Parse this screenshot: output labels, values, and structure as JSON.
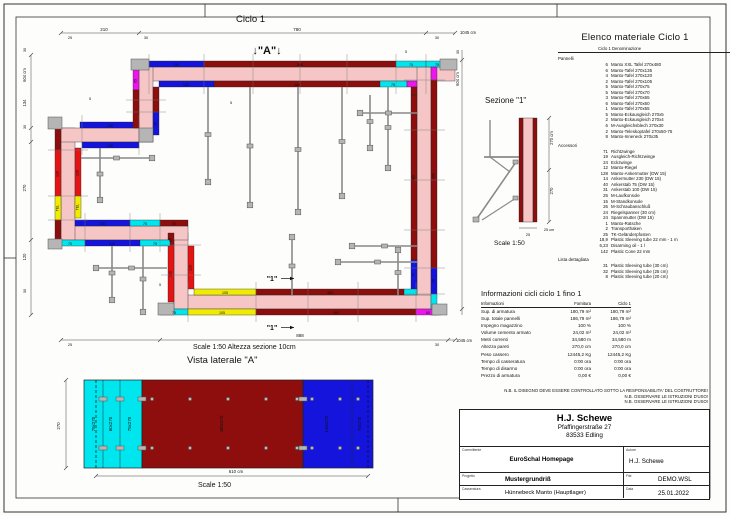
{
  "sheet": {
    "ciclo_label": "Ciclo 1",
    "a_marker": "↓\"A\"↓",
    "cut_marker": "\"1\"",
    "plan_scale_note": "Scale 1:50   Altezza sezione 10cm",
    "vista_title": "Vista laterale \"A\"",
    "vista_scale": "Scale 1:50",
    "sezione_title": "Sezione \"1\"",
    "sezione_scale": "Scale 1:50"
  },
  "colors": {
    "wall": "#f6c5c5",
    "panel_xxl_darkred": "#8e0e0e",
    "panel_red": "#e51414",
    "panel_blue": "#1414dc",
    "panel_cyan": "#00e6ee",
    "panel_magenta": "#ee14ee",
    "panel_yellow": "#f0ec00",
    "hardware_gray": "#b5b5b5"
  },
  "plan": {
    "dim_labels": [
      {
        "t": "210",
        "x": 104,
        "y": 31,
        "r": 0,
        "s": 4.5
      },
      {
        "t": "780",
        "x": 297,
        "y": 31,
        "r": 0,
        "s": 4.5
      },
      {
        "t": "1045 cm",
        "x": 468,
        "y": 34,
        "r": 0,
        "s": 4.2
      },
      {
        "t": "25",
        "x": 70,
        "y": 39,
        "r": 0,
        "s": 3.8
      },
      {
        "t": "30",
        "x": 146,
        "y": 39,
        "r": 0,
        "s": 3.8
      },
      {
        "t": "30",
        "x": 437,
        "y": 39,
        "r": 0,
        "s": 3.8
      },
      {
        "t": "30",
        "x": 26,
        "y": 50,
        "r": -90,
        "s": 3.8
      },
      {
        "t": "604 cm",
        "x": 26,
        "y": 75,
        "r": -90,
        "s": 4.2
      },
      {
        "t": "134",
        "x": 26,
        "y": 103,
        "r": -90,
        "s": 4.2
      },
      {
        "t": "30",
        "x": 26,
        "y": 127,
        "r": -90,
        "s": 3.8
      },
      {
        "t": "270",
        "x": 26,
        "y": 188,
        "r": -90,
        "s": 4.2
      },
      {
        "t": "120",
        "x": 26,
        "y": 257,
        "r": -90,
        "s": 4.2
      },
      {
        "t": "30",
        "x": 26,
        "y": 291,
        "r": -90,
        "s": 3.8
      },
      {
        "t": "25",
        "x": 70,
        "y": 346,
        "r": 0,
        "s": 3.8
      },
      {
        "t": "888",
        "x": 300,
        "y": 337,
        "r": 0,
        "s": 4.5
      },
      {
        "t": "30",
        "x": 437,
        "y": 346,
        "r": 0,
        "s": 3.8
      },
      {
        "t": "1045 cm",
        "x": 464,
        "y": 342,
        "r": 0,
        "s": 4.2
      },
      {
        "t": "30",
        "x": 459,
        "y": 52,
        "r": -90,
        "s": 3.8
      },
      {
        "t": "604 cm",
        "x": 459,
        "y": 79,
        "r": -90,
        "s": 4.2
      }
    ],
    "panel_labels": [
      {
        "t": "135",
        "x": 176,
        "y": 65.8,
        "r": 0
      },
      {
        "t": "480",
        "x": 300,
        "y": 65.8,
        "r": 0
      },
      {
        "t": "75",
        "x": 411,
        "y": 65.8,
        "r": 0
      },
      {
        "t": "75",
        "x": 437,
        "y": 65.8,
        "r": 0
      },
      {
        "t": "135",
        "x": 186,
        "y": 85.8,
        "r": 0
      },
      {
        "t": "480",
        "x": 297,
        "y": 85.8,
        "r": 0
      },
      {
        "t": "75",
        "x": 393,
        "y": 85.8,
        "r": 0
      },
      {
        "t": "480",
        "x": 434.5,
        "y": 176,
        "r": -90
      },
      {
        "t": "70",
        "x": 434.5,
        "y": 281,
        "r": -90
      },
      {
        "t": "480",
        "x": 414.5,
        "y": 178,
        "r": -90
      },
      {
        "t": "70",
        "x": 414.5,
        "y": 275,
        "r": -90
      },
      {
        "t": "105",
        "x": 225,
        "y": 293.8,
        "r": 0
      },
      {
        "t": "480",
        "x": 330,
        "y": 293.8,
        "r": 0
      },
      {
        "t": "75",
        "x": 174,
        "y": 313.8,
        "r": 0
      },
      {
        "t": "105",
        "x": 222,
        "y": 313.8,
        "r": 0
      },
      {
        "t": "480",
        "x": 336,
        "y": 313.8,
        "r": 0
      },
      {
        "t": "65",
        "x": 428,
        "y": 313.8,
        "r": 0
      },
      {
        "t": "30",
        "x": 171.5,
        "y": 240,
        "r": -90
      },
      {
        "t": "120",
        "x": 171.5,
        "y": 274,
        "r": -90
      },
      {
        "t": "120",
        "x": 191.5,
        "y": 268,
        "r": -90
      },
      {
        "t": "135",
        "x": 102,
        "y": 224.8,
        "r": 0
      },
      {
        "t": "75",
        "x": 145,
        "y": 224.8,
        "r": 0
      },
      {
        "t": "30",
        "x": 174,
        "y": 224.8,
        "r": 0
      },
      {
        "t": "75",
        "x": 70,
        "y": 244.8,
        "r": 0
      },
      {
        "t": "135",
        "x": 112,
        "y": 244.8,
        "r": 0
      },
      {
        "t": "75",
        "x": 155,
        "y": 244.8,
        "r": 0
      },
      {
        "t": "120",
        "x": 58.5,
        "y": 174,
        "r": -90
      },
      {
        "t": "TEL",
        "x": 58.5,
        "y": 208,
        "r": -90
      },
      {
        "t": "120",
        "x": 78.5,
        "y": 173,
        "r": -90
      },
      {
        "t": "TEL",
        "x": 78.5,
        "y": 207,
        "r": -90
      },
      {
        "t": "135",
        "x": 110,
        "y": 126.8,
        "r": 0
      },
      {
        "t": "135",
        "x": 110,
        "y": 146.8,
        "r": 0
      },
      {
        "t": "65",
        "x": 136.5,
        "y": 81,
        "r": -90
      },
      {
        "t": "35",
        "x": 156.5,
        "y": 124,
        "r": -90
      }
    ],
    "annotations": [
      {
        "t": "5",
        "x": 231,
        "y": 104
      },
      {
        "t": "5",
        "x": 90,
        "y": 100
      },
      {
        "t": "5",
        "x": 406,
        "y": 53
      },
      {
        "t": "5",
        "x": 160,
        "y": 286
      }
    ]
  },
  "sezione": {
    "labels": [
      {
        "t": "270 cm",
        "x": 553,
        "y": 138,
        "r": -90,
        "s": 4.2
      },
      {
        "t": "270",
        "x": 553,
        "y": 191,
        "r": -90,
        "s": 4.2
      },
      {
        "t": "25 cm",
        "x": 549,
        "y": 231,
        "r": 0,
        "s": 3.8
      },
      {
        "t": "25",
        "x": 528,
        "y": 236,
        "r": 0,
        "s": 3.8
      }
    ]
  },
  "vista": {
    "labels": [
      {
        "t": "75x270",
        "x": 95,
        "y": 424,
        "r": -90,
        "s": 4.4
      },
      {
        "t": "60x270",
        "x": 112,
        "y": 424,
        "r": -90,
        "s": 4.4
      },
      {
        "t": "75x270",
        "x": 131,
        "y": 424,
        "r": -90,
        "s": 4.4
      },
      {
        "t": "480x270",
        "x": 223,
        "y": 424,
        "r": -90,
        "s": 4.4
      },
      {
        "t": "135x270",
        "x": 328,
        "y": 424,
        "r": -90,
        "s": 4.4
      },
      {
        "t": "70x270",
        "x": 361,
        "y": 424,
        "r": -90,
        "s": 4.4
      },
      {
        "t": "270",
        "x": 60,
        "y": 426,
        "r": -90,
        "s": 4.4
      },
      {
        "t": "610 cm",
        "x": 236,
        "y": 473,
        "r": 0,
        "s": 4.4
      }
    ]
  },
  "material_list": {
    "title": "Elenco materiale  Ciclo 1",
    "col_header": "Ciclo 1   Denominazione",
    "groups": [
      {
        "name": "Pannelli",
        "items": [
          {
            "qty": "6",
            "name": "Manto XXL Tafel 270x480"
          },
          {
            "qty": "6",
            "name": "Manto-Tafel 270x135"
          },
          {
            "qty": "4",
            "name": "Manto-Tafel 270x120"
          },
          {
            "qty": "2",
            "name": "Manto-Tafel 270x105"
          },
          {
            "qty": "5",
            "name": "Manto-Tafel 270x75"
          },
          {
            "qty": "5",
            "name": "Manto-Tafel 270x70"
          },
          {
            "qty": "3",
            "name": "Manto-Tafel 270x65"
          },
          {
            "qty": "6",
            "name": "Manto-Tafel 270x60"
          },
          {
            "qty": "1",
            "name": "Manto-Tafel 270x55"
          },
          {
            "qty": "5",
            "name": "Manto-Eckausgleich 270x5"
          },
          {
            "qty": "2",
            "name": "Manto-Eckausgleich 270x4"
          },
          {
            "qty": "6",
            "name": "M-Ausgleichsblech 270x30"
          },
          {
            "qty": "2",
            "name": "Manto-Teleskoptafel  270x50-75"
          },
          {
            "qty": "8",
            "name": "Manto-Inneneck 270x35"
          }
        ]
      },
      {
        "name": "Accessori",
        "items": [
          {
            "qty": "71",
            "name": "Richtzwinge"
          },
          {
            "qty": "19",
            "name": "Ausgleich-Richtzwinge"
          },
          {
            "qty": "24",
            "name": "Eckzwinge"
          },
          {
            "qty": "12",
            "name": "Manto-Riegel"
          },
          {
            "qty": "128",
            "name": "Manto-Ankermutter (DW 15)"
          },
          {
            "qty": "14",
            "name": "Ankermutter 230 (DW 15)"
          },
          {
            "qty": "40",
            "name": "Ankerstab  75 (DW 15)"
          },
          {
            "qty": "31",
            "name": "Ankerstab 100 (DW 15)"
          },
          {
            "qty": "25",
            "name": "M-Laufkonsole"
          },
          {
            "qty": "15",
            "name": "M-Standkonsole"
          },
          {
            "qty": "26",
            "name": "M-Schraubanschluß"
          },
          {
            "qty": "24",
            "name": "Riegelspanner (30 cm)"
          },
          {
            "qty": "24",
            "name": "Spannmutter (DW 15)"
          },
          {
            "qty": "1",
            "name": "Manto-Ratsche"
          },
          {
            "qty": "2",
            "name": "Transporthaken"
          },
          {
            "qty": "25",
            "name": "TK-Geländerpfosten"
          },
          {
            "qty": "18,9",
            "name": "Plastic Sleeving tube 22 mm - 1 m"
          },
          {
            "qty": "6,23",
            "name": "Disarming oil - 1 l"
          },
          {
            "qty": "142",
            "name": "Plastic Cone 22 mm"
          }
        ]
      },
      {
        "name": "Lista dettagliata",
        "items": [
          {
            "qty": "31",
            "name": "Plastic Sleeving tube  (30 cm)"
          },
          {
            "qty": "32",
            "name": "Plastic Sleeving tube  (25 cm)"
          },
          {
            "qty": "8",
            "name": "Plastic Sleeving tube  (20 cm)"
          }
        ]
      }
    ]
  },
  "info_table": {
    "title": "Informazioni cicli  ciclo 1 fino 1",
    "headers": {
      "c1": "Informazioni",
      "c2": "Fornitura",
      "c3": "Ciclo 1"
    },
    "rows": [
      {
        "label": "Sup. di armatura",
        "fornitura": "180,79 m²",
        "ciclo1": "180,79 m²"
      },
      {
        "label": "Sup. totale pannelli",
        "fornitura": "186,79 m²",
        "ciclo1": "186,79 m²"
      },
      {
        "label": "Impegno magazzino",
        "fornitura": "100 %",
        "ciclo1": "100 %"
      },
      {
        "label": "Volume cemento armato",
        "fornitura": "24,02 m³",
        "ciclo1": "24,02 m³"
      },
      {
        "label": "Metri correnti",
        "fornitura": "34,580 m",
        "ciclo1": "34,580 m"
      },
      {
        "label": "Altezza pareti",
        "fornitura": "270,0 cm",
        "ciclo1": "270,0 cm"
      },
      {
        "label": "Peso cassero",
        "fornitura": "12445,2 Kg",
        "ciclo1": "12445,2 Kg"
      },
      {
        "label": "Tempo di casseratura",
        "fornitura": "0:00 ora",
        "ciclo1": "0:00 ora"
      },
      {
        "label": "Tempo di disarmo",
        "fornitura": "0:00 ora",
        "ciclo1": "0:00 ora"
      },
      {
        "label": "Prezzo di armatura",
        "fornitura": "0,00 €",
        "ciclo1": "0,00 €"
      }
    ]
  },
  "nb_lines": [
    "N.B. IL DISEGNO DEVE ESSERE CONTROLLATO SOTTO LA RESPONSABILITA' DEL COSTRUTTORE!",
    "N.B. OSSERVARE LE ISTRUZIONI D'USO!",
    "N.B. OSSERVARE LE ISTRUZIONI D'USO!"
  ],
  "title_block": {
    "company": "H.J. Schewe",
    "address1": "Pfaffingerstraße 27",
    "address2": "83533 Edling",
    "committente_label": "Committente",
    "committente": "EuroSchal Homepage",
    "autore_label": "Autore",
    "autore": "H.J. Schewe",
    "progetto_label": "Progetto",
    "progetto": "Mustergrundriß",
    "file_label": "File",
    "file": "DEMO.WSL",
    "casseratura_label": "Casseratura",
    "casseratura": "Hünnebeck Manto (Hauptlager)",
    "data_label": "Data",
    "data": "25.01.2022"
  }
}
